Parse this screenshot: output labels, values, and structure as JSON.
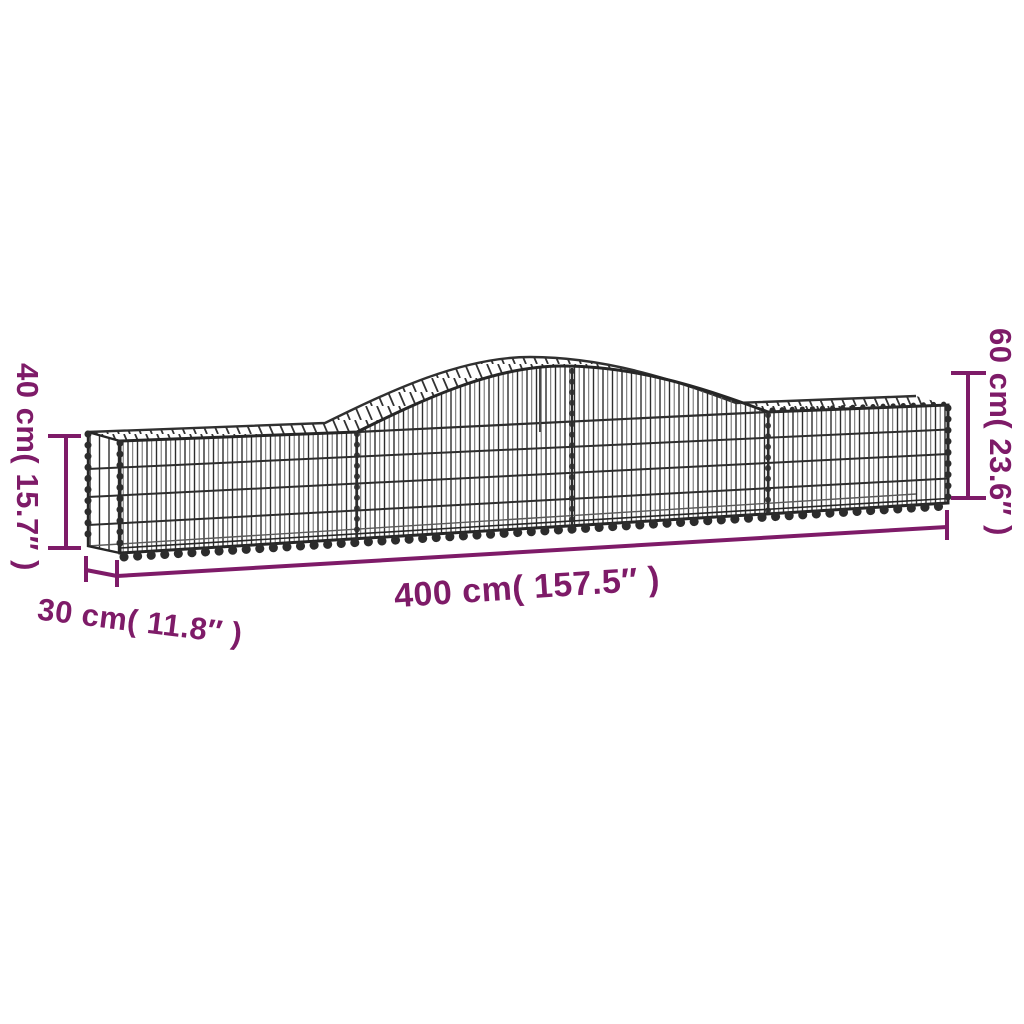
{
  "illustration": {
    "name": "arched-gabion-wire-basket",
    "wire_color": "#2d2d2d",
    "background": "#ffffff"
  },
  "dimensions": {
    "accent_color": "#7e1b68",
    "height_left": "40 cm( 15.7″ )",
    "height_right": "60 cm( 23.6″ )",
    "length": "400 cm( 157.5″ )",
    "depth": "30 cm( 11.8″ )"
  }
}
